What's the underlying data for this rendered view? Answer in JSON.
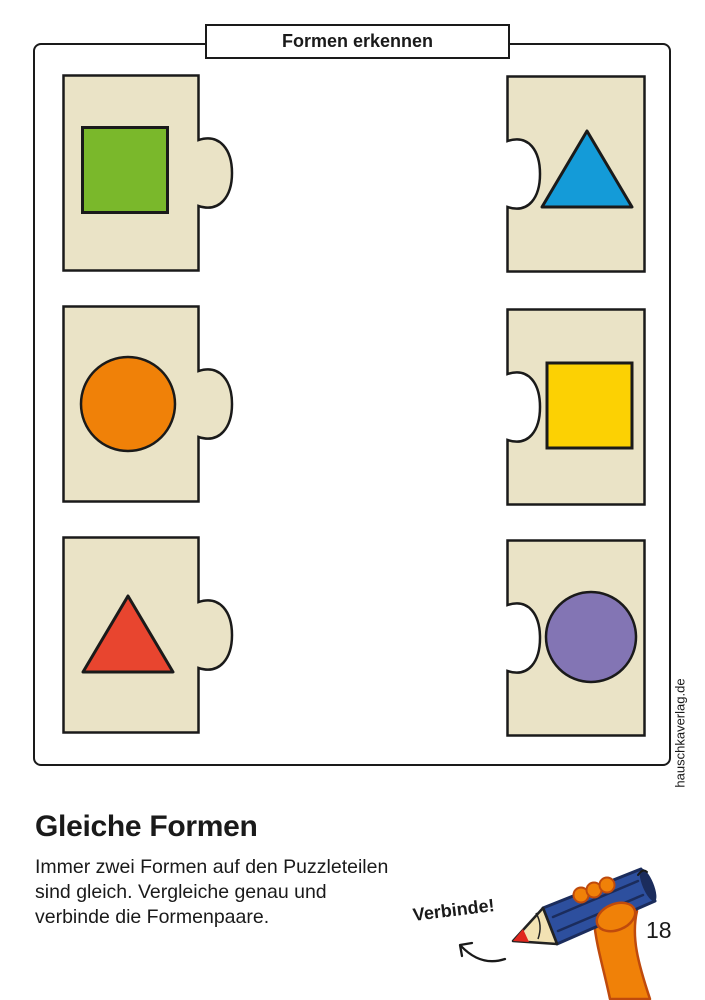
{
  "header": {
    "title": "Formen erkennen"
  },
  "worksheet": {
    "heading": "Gleiche Formen",
    "instructions": "Immer zwei Formen auf den Puzzleteilen\nsind gleich. Vergleiche genau und\nverbinde die Formenpaare.",
    "action_label": "Verbinde!"
  },
  "page": {
    "number": "18",
    "brand_vertical": "hauschkaverlag.de"
  },
  "colors": {
    "piece_bg": "#eae3c6",
    "outline": "#1a1a1a",
    "green": "#7ab82b",
    "blue": "#149bd8",
    "orange": "#f08108",
    "yellow": "#fcd103",
    "red": "#e8452f",
    "purple": "#8375b4",
    "pencil_blue": "#2d4f9e",
    "pencil_dark": "#1b2c5c",
    "wood": "#f2e2b3",
    "lead_red": "#e0261d",
    "skin_orange": "#f08108",
    "skin_outline": "#bf4a0c"
  },
  "puzzle": {
    "pieces": [
      {
        "id": "green-square",
        "column": "left",
        "row": 0,
        "shape": "square",
        "color_key": "green"
      },
      {
        "id": "blue-triangle",
        "column": "right",
        "row": 0,
        "shape": "triangle",
        "color_key": "blue"
      },
      {
        "id": "orange-circle",
        "column": "left",
        "row": 1,
        "shape": "circle",
        "color_key": "orange"
      },
      {
        "id": "yellow-square",
        "column": "right",
        "row": 1,
        "shape": "square",
        "color_key": "yellow"
      },
      {
        "id": "red-triangle",
        "column": "left",
        "row": 2,
        "shape": "triangle",
        "color_key": "red"
      },
      {
        "id": "purple-circle",
        "column": "right",
        "row": 2,
        "shape": "circle",
        "color_key": "purple"
      }
    ]
  }
}
